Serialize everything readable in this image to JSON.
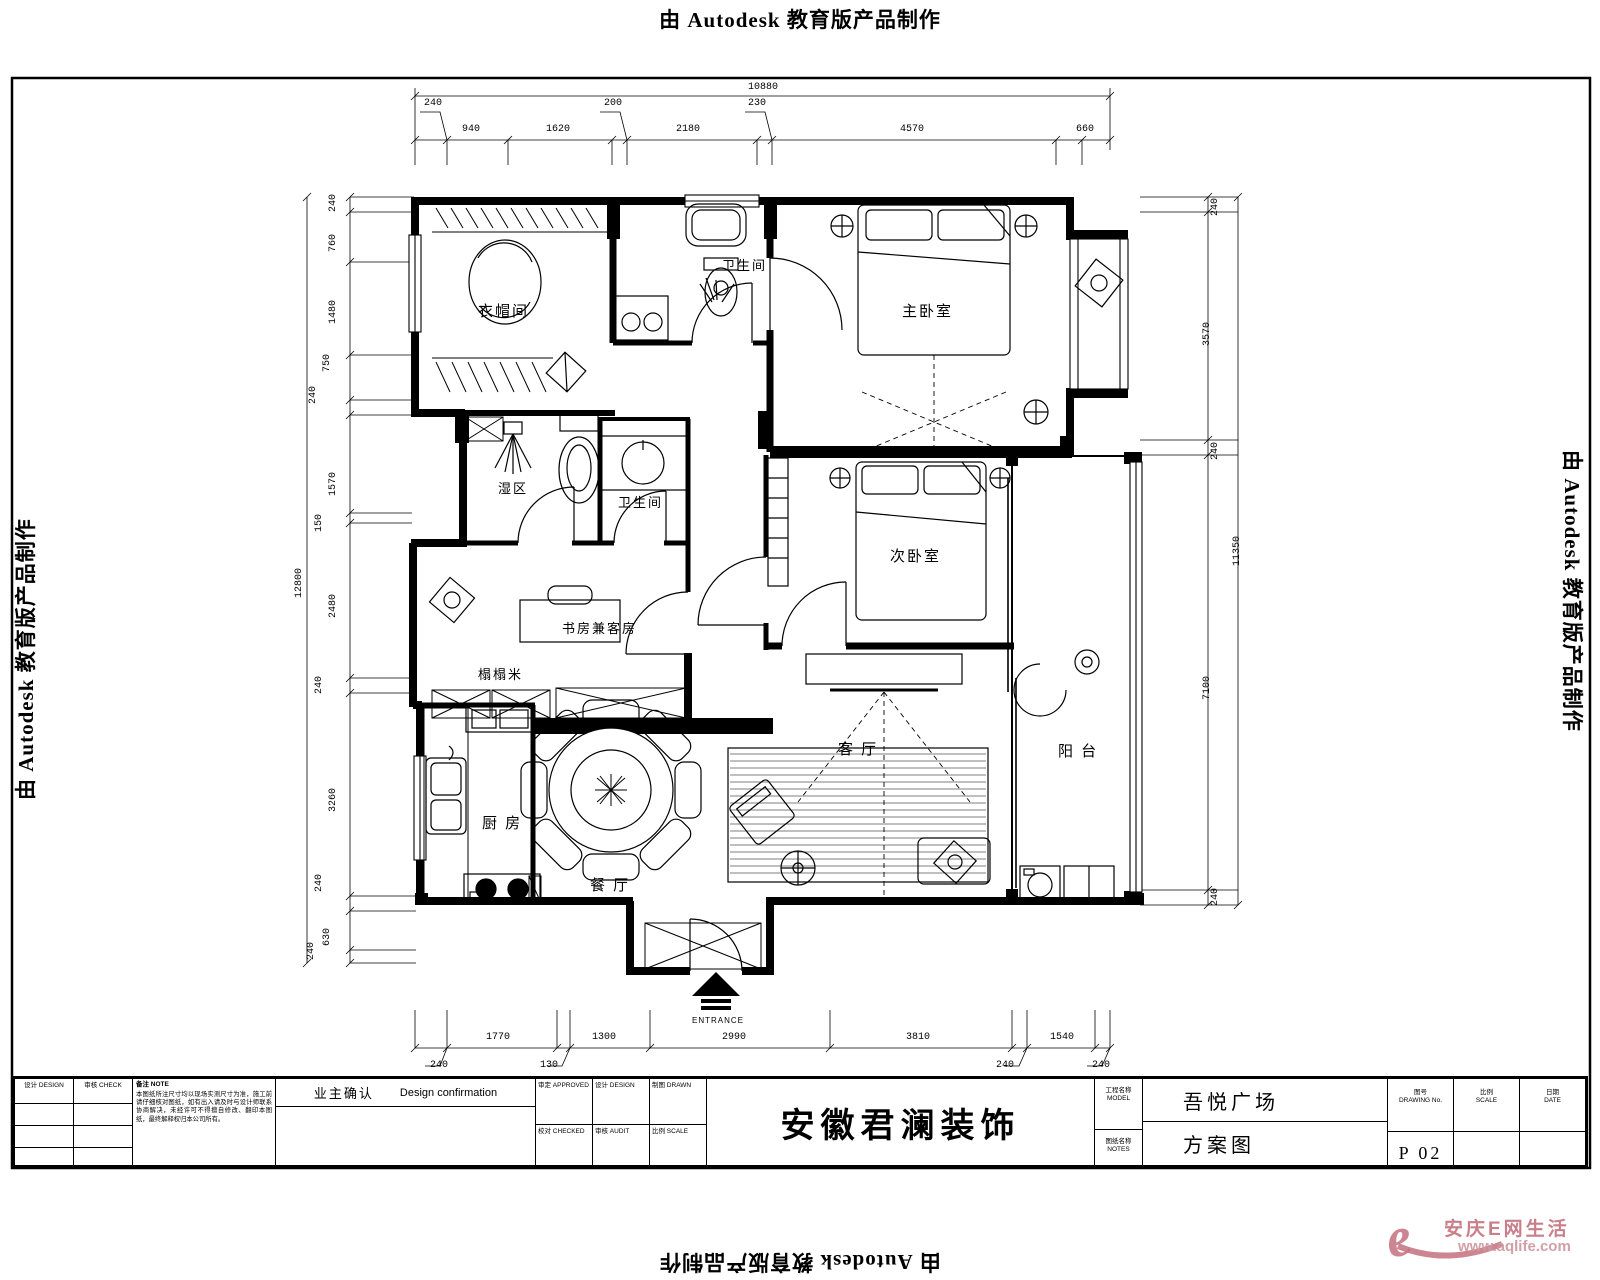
{
  "banner": {
    "text": "由 Autodesk 教育版产品制作"
  },
  "rooms": {
    "cloakroom": "衣帽间",
    "bath_top": "卫生间",
    "master_bedroom": "主卧室",
    "wet_area": "湿区",
    "bath_mid": "卫生间",
    "second_bedroom": "次卧室",
    "study_guest": "书房兼客房",
    "tatami": "榻榻米",
    "living": "客 厅",
    "balcony": "阳 台",
    "kitchen": "厨 房",
    "dining": "餐 厅",
    "entrance": "ENTRANCE"
  },
  "dims": {
    "top": {
      "total": "10880",
      "seg": [
        "940",
        "1620",
        "2180",
        "4570",
        "660"
      ],
      "off": [
        "240",
        "200",
        "230"
      ]
    },
    "left": {
      "total": "12800",
      "labels": [
        "240",
        "760",
        "1480",
        "750",
        "240",
        "1570",
        "150",
        "2480",
        "240",
        "3260",
        "240",
        "630",
        "240"
      ]
    },
    "right": {
      "total": "11350",
      "labels": [
        "240",
        "3570",
        "240",
        "7100",
        "240"
      ]
    },
    "bottom": {
      "seg": [
        "1770",
        "1300",
        "2990",
        "3810",
        "1540"
      ],
      "off": [
        "240",
        "130",
        "240",
        "240"
      ]
    }
  },
  "title_block": {
    "left_h1": "设计 DESIGN",
    "left_h2": "审核 CHECK",
    "note_header": "备注  NOTE",
    "note_body": "本图纸所注尺寸均以现场实测尺寸为准，施工前请仔细核对图纸，如有出入请及时与设计师联系协商解决，未经许可不得擅自修改、翻印本图纸，最终解释权归本公司所有。",
    "owner_cn": "业主确认",
    "owner_en": "Design confirmation",
    "mid_cells": [
      [
        "审定 APPROVED",
        "设计 DESIGN",
        "制图 DRAWN"
      ],
      [
        "校对 CHECKED",
        "审核 AUDIT",
        "比例 SCALE"
      ]
    ],
    "company": "安徽君澜装饰",
    "project_label_cn": "工程名称",
    "project_label_en": "MODEL",
    "project_value": "吾悦广场",
    "sheet_label_cn": "图纸名称",
    "sheet_label_en": "NOTES",
    "sheet_value": "方案图",
    "no_label_cn": "图号",
    "no_label_en": "DRAWING No.",
    "scale_label_cn": "比例",
    "scale_label_en": "SCALE",
    "date_label_cn": "日期",
    "date_label_en": "DATE",
    "page_no": "P 02"
  },
  "watermark": {
    "cn": "安庆E网生活",
    "url": "www.aqlife.com",
    "color": "#c4717e"
  }
}
